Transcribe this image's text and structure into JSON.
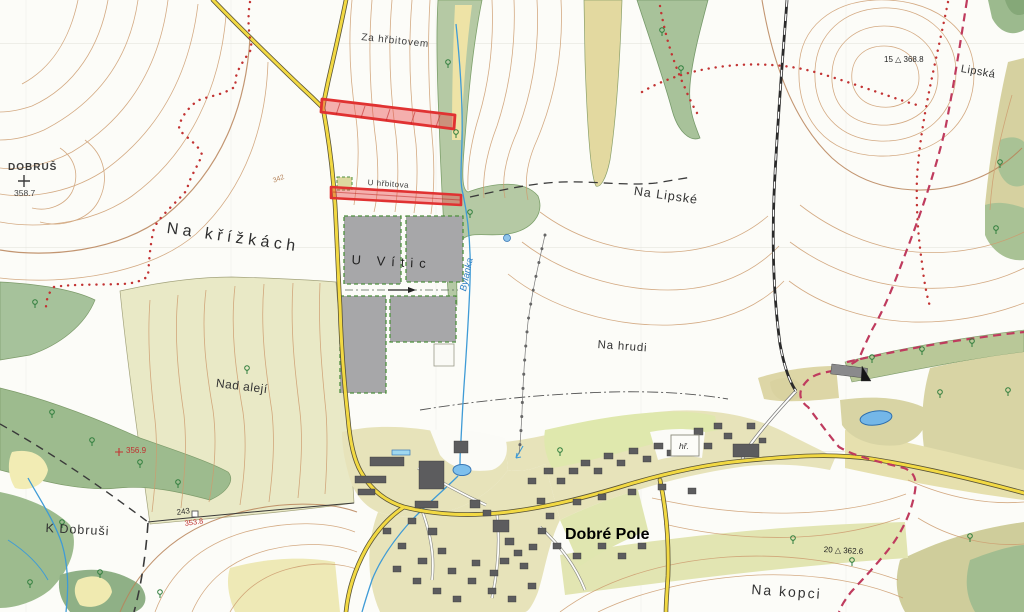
{
  "map": {
    "place_labels": {
      "za_hrbitovem": "Za hřbitovem",
      "dobrus": "DOBRUŠ",
      "na_krizkach": "Na křížkách",
      "u_vitic": "U Vític",
      "u_hrbitova": "U hřbitova",
      "na_lipske": "Na Lipské",
      "lipska": "Lipská",
      "na_hrudi": "Na hrudi",
      "dobre_pole": "Dobré Pole",
      "na_kopci": "Na kopci",
      "nad_aleji": "Nad alejí",
      "k_dobrusi": "K Dobruši",
      "hrbitov_abbr": "hř."
    },
    "water_labels": {
      "stream_name": "Bylanka"
    },
    "elevations": {
      "trig_point_15": "15 △ 368.8",
      "trig_point_20": "20 △ 362.6",
      "spot_dobrus": "358.7",
      "spot_356": "356.9",
      "spot_243": "243",
      "spot_353": "353.8",
      "contour_342": "342"
    },
    "colors": {
      "highlight_red": "#e03232",
      "road_yellow": "#f2d943",
      "forest_green": "#9dbb8e",
      "field_olive": "#d6d1a2",
      "contour_brown": "#cd9c6f",
      "water_blue": "#3f9bd6",
      "boundary_red": "#bf3b5e"
    }
  }
}
